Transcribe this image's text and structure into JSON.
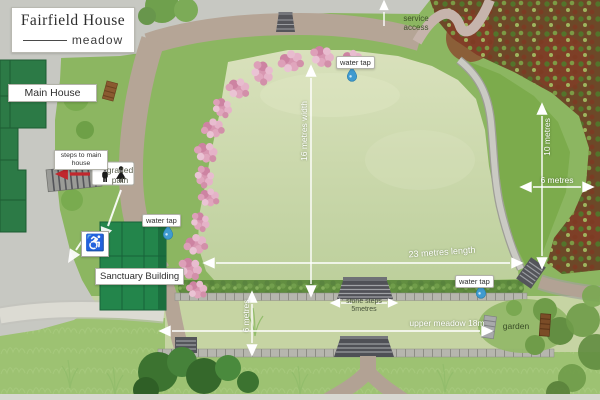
{
  "window": {
    "width": 600,
    "height": 400
  },
  "title": {
    "name": "Fairfield House",
    "subtitle": "meadow"
  },
  "buildings": {
    "main_house": "Main House",
    "sanctuary": "Sanctuary Building"
  },
  "labels": {
    "steps_to_main_house": "steps to main house",
    "graded_path": {
      "line1": "graded",
      "line2": "path"
    },
    "service_access": {
      "line1": "service",
      "line2": "access"
    },
    "water_tap": "water tap",
    "garden": "garden"
  },
  "dimensions": {
    "meadow_width": "16 metres width",
    "meadow_length": "23 metres length",
    "east_border_length": "10 metres",
    "east_border_width": "6 metres",
    "upper_meadow_depth": "6 metres",
    "stone_steps": {
      "line1": "stone steps",
      "line2": "5metres"
    },
    "upper_meadow_length": "upper meadow 18m"
  },
  "icons": {
    "wheelchair_glyph": "♿",
    "toilets": "toilets-icon",
    "water_drop": "water-drop-icon",
    "red_arrow": "arrow-to-toilets-icon"
  },
  "colors": {
    "grass": "#8cb661",
    "pale_meadow": "#cdd9ae",
    "paving": "#c7c8c2",
    "path_brown": "#b5a596",
    "woodland": "#6d4828",
    "building_green": "#23854b",
    "blossom_pink": "#d897b1",
    "water_blue": "#3f9bd0",
    "dimension_white": "#ffffff",
    "toilet_arrow_red": "#c1272d"
  }
}
